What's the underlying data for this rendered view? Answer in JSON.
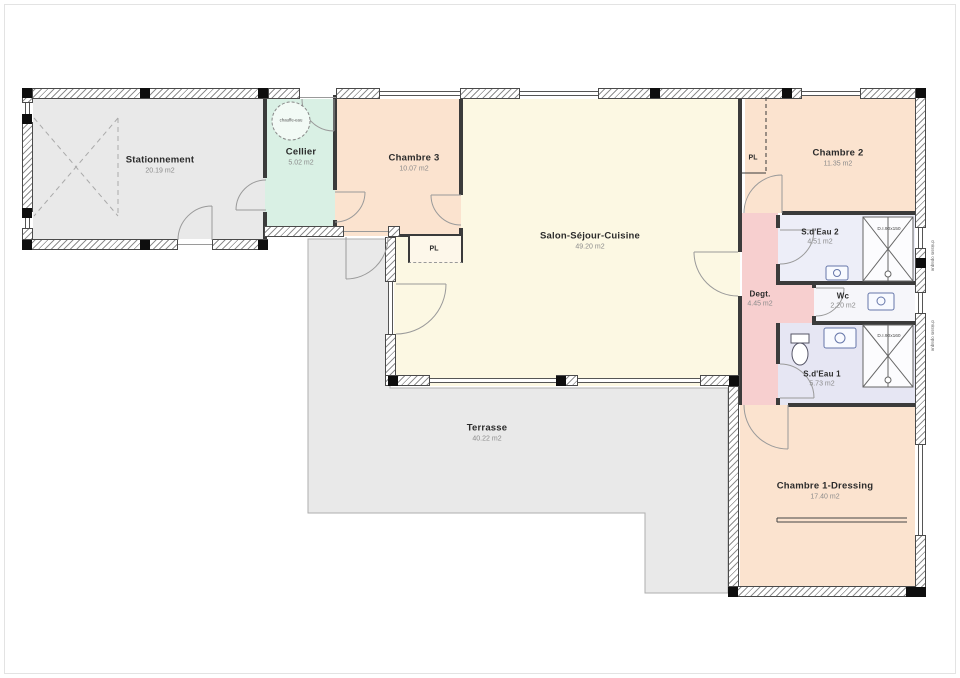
{
  "plan": {
    "rooms": [
      {
        "id": "stationnement",
        "name": "Stationnement",
        "area": "20.19 m2"
      },
      {
        "id": "cellier",
        "name": "Cellier",
        "area": "5.02 m2"
      },
      {
        "id": "chambre3",
        "name": "Chambre 3",
        "area": "10.07 m2"
      },
      {
        "id": "salon",
        "name": "Salon-Séjour-Cuisine",
        "area": "49.20 m2"
      },
      {
        "id": "chambre2",
        "name": "Chambre 2",
        "area": "11.35 m2"
      },
      {
        "id": "sdeau2",
        "name": "S.d'Eau 2",
        "area": "4.51 m2"
      },
      {
        "id": "degagement",
        "name": "Degt.",
        "area": "4.45 m2"
      },
      {
        "id": "wc",
        "name": "Wc",
        "area": "2.20 m2"
      },
      {
        "id": "sdeau1",
        "name": "S.d'Eau 1",
        "area": "5.73 m2"
      },
      {
        "id": "chambre1",
        "name": "Chambre 1-Dressing",
        "area": "17.40 m2"
      },
      {
        "id": "terrasse",
        "name": "Terrasse",
        "area": "40.22 m2"
      }
    ],
    "labels": {
      "closet": "PL",
      "shower_top": "D.I.90x150",
      "shower_bottom": "D.I.90x160",
      "water_heater": "chauffe-eau",
      "window_note": "châssis opaque"
    },
    "colors": {
      "bedroom": "#fbe3cf",
      "living": "#fcf8e3",
      "cellar": "#d9f0e4",
      "garage": "#e9e9e9",
      "terrace": "#e9e9e9",
      "hall": "#f7cfcf",
      "bath2": "#edeef8",
      "bath1": "#e6e6f3",
      "wc": "#f6f6fa"
    }
  }
}
